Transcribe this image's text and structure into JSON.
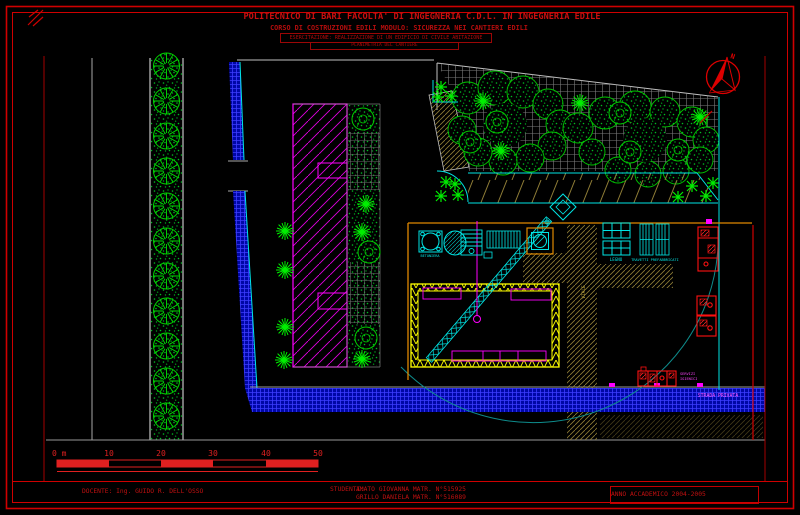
{
  "header": {
    "line1": "POLITECNICO DI BARI    FACOLTA' DI INGEGNERIA  C.D.L. IN INGEGNERIA EDILE",
    "line2": "CORSO DI COSTRUZIONI EDILI     MODULO: SICUREZZA NEI CANTIERI EDILI",
    "line3": "ESERCITAZIONE: REALIZZAZIONE DI UN EDIFICIO DI CIVILE ABITAZIONE",
    "line4": "PLANIMETRIA DEL CANTIERE"
  },
  "footer": {
    "docente": "DOCENTE: Ing. GUIDO R. DELL'OSSO",
    "studenti_label": "STUDENTI:",
    "studente1": "AMATO GIOVANNA  MATR. N°515925",
    "studente2": "GRILLO DANIELA  MATR. N°516089",
    "anno": "ANNO ACCADEMICO 2004-2005"
  },
  "scale_bar": {
    "unit_label": "0 m",
    "labels": [
      "10",
      "20",
      "30",
      "40",
      "50"
    ]
  },
  "labels": {
    "legno": "LEGNO",
    "travetti": "TRAVETTI PREFABBRICATI",
    "servizi1": "SERVIZI",
    "servizi2": "IGIENICI",
    "strada": "STRADA PRIVATA",
    "via": "VIALE",
    "betoniera": "BETONIERA",
    "north": "N"
  },
  "colors": {
    "frame_red": "#cf0000",
    "magenta": "#ff00ff",
    "cyan": "#00e5e5",
    "tree_green": "#00dd00",
    "road_blue": "#0008b0",
    "hatch_tan": "#8f7d36",
    "scaffold_yellow": "#ffff00",
    "fence_orange": "#e08800",
    "container_red": "#ff1111",
    "arc_teal": "#0e8c8c"
  }
}
